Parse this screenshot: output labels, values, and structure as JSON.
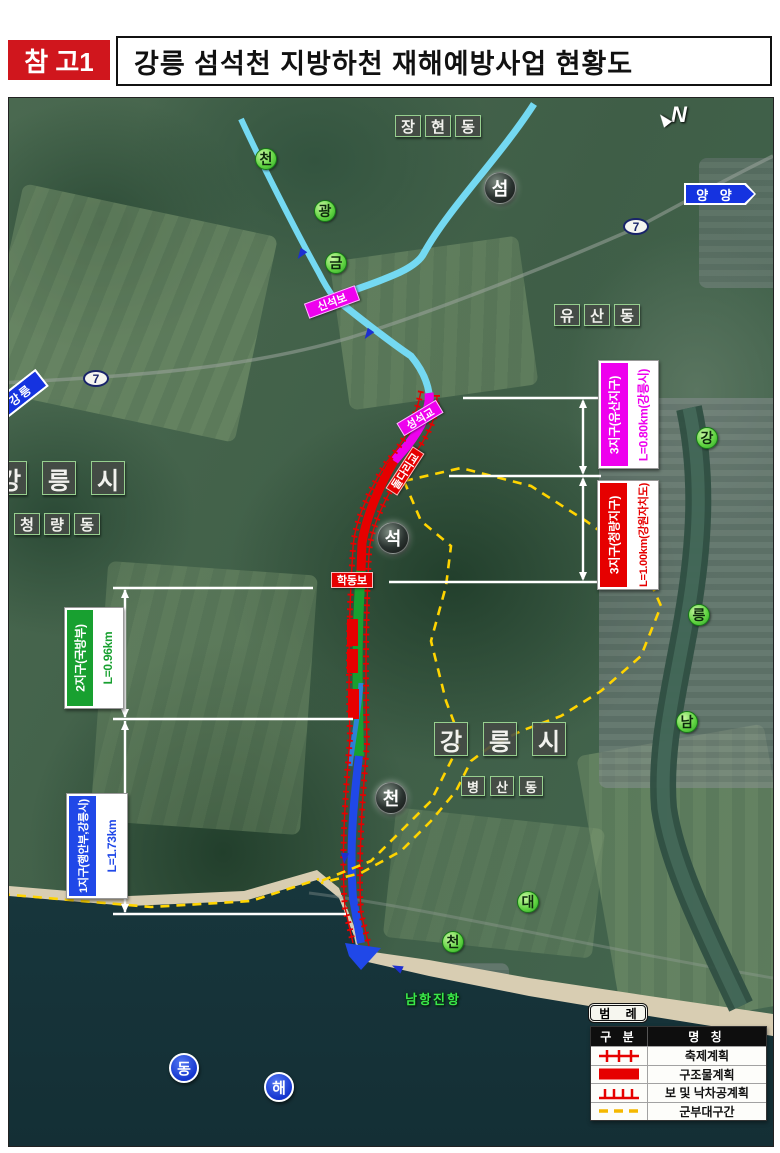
{
  "header": {
    "ref_label": "참 고1",
    "title": "강릉 섬석천 지방하천 재해예방사업 현황도"
  },
  "map": {
    "compass_label": "N",
    "signs": {
      "yangyang": "양 양",
      "gangneung": "강릉",
      "route_number": "7"
    },
    "place_labels": {
      "janghyeondong": [
        "장",
        "현",
        "동"
      ],
      "yusandong": [
        "유",
        "산",
        "동"
      ],
      "cheongnyangdong": [
        "청",
        "량",
        "동"
      ],
      "byeongsandong": [
        "병",
        "산",
        "동"
      ],
      "gangneung_city": [
        "강",
        "릉",
        "시"
      ]
    },
    "river_markers": {
      "geumgwangcheon": [
        "천",
        "광",
        "금"
      ],
      "seomseokcheon": [
        "섬",
        "석",
        "천"
      ],
      "namdaecheon": [
        "강",
        "릉",
        "남",
        "대",
        "천"
      ]
    },
    "sea_label": [
      "동",
      "해"
    ],
    "port_label": "남항진항",
    "structures": {
      "sinseokbo": "신석보",
      "seongseokgyo": "성석교",
      "doldarigyo": "돌다리교",
      "hakdongbo": "학동보"
    },
    "sections": [
      {
        "name": "3지구(유산지구)",
        "length": "L=0.80km(강릉시)",
        "color": "#ee00ee"
      },
      {
        "name": "3지구(청량지구)",
        "length": "L=1.00km(강원자치도)",
        "color": "#e60000"
      },
      {
        "name": "2지구(국방부)",
        "length": "L=0.96km",
        "color": "#18a030"
      },
      {
        "name": "1지구(행안부,강릉시)",
        "length": "L=1.73km",
        "color": "#2048e8"
      }
    ],
    "legend": {
      "title": "범 례",
      "col_type": "구 분",
      "col_name": "명 칭",
      "rows": [
        {
          "name": "축제계획",
          "symbol": "embankment-line"
        },
        {
          "name": "구조물계획",
          "symbol": "structure-solid"
        },
        {
          "name": "보 및 낙차공계획",
          "symbol": "weir-drop-comb"
        },
        {
          "name": "군부대구간",
          "symbol": "military-zone-dashed"
        }
      ]
    }
  }
}
